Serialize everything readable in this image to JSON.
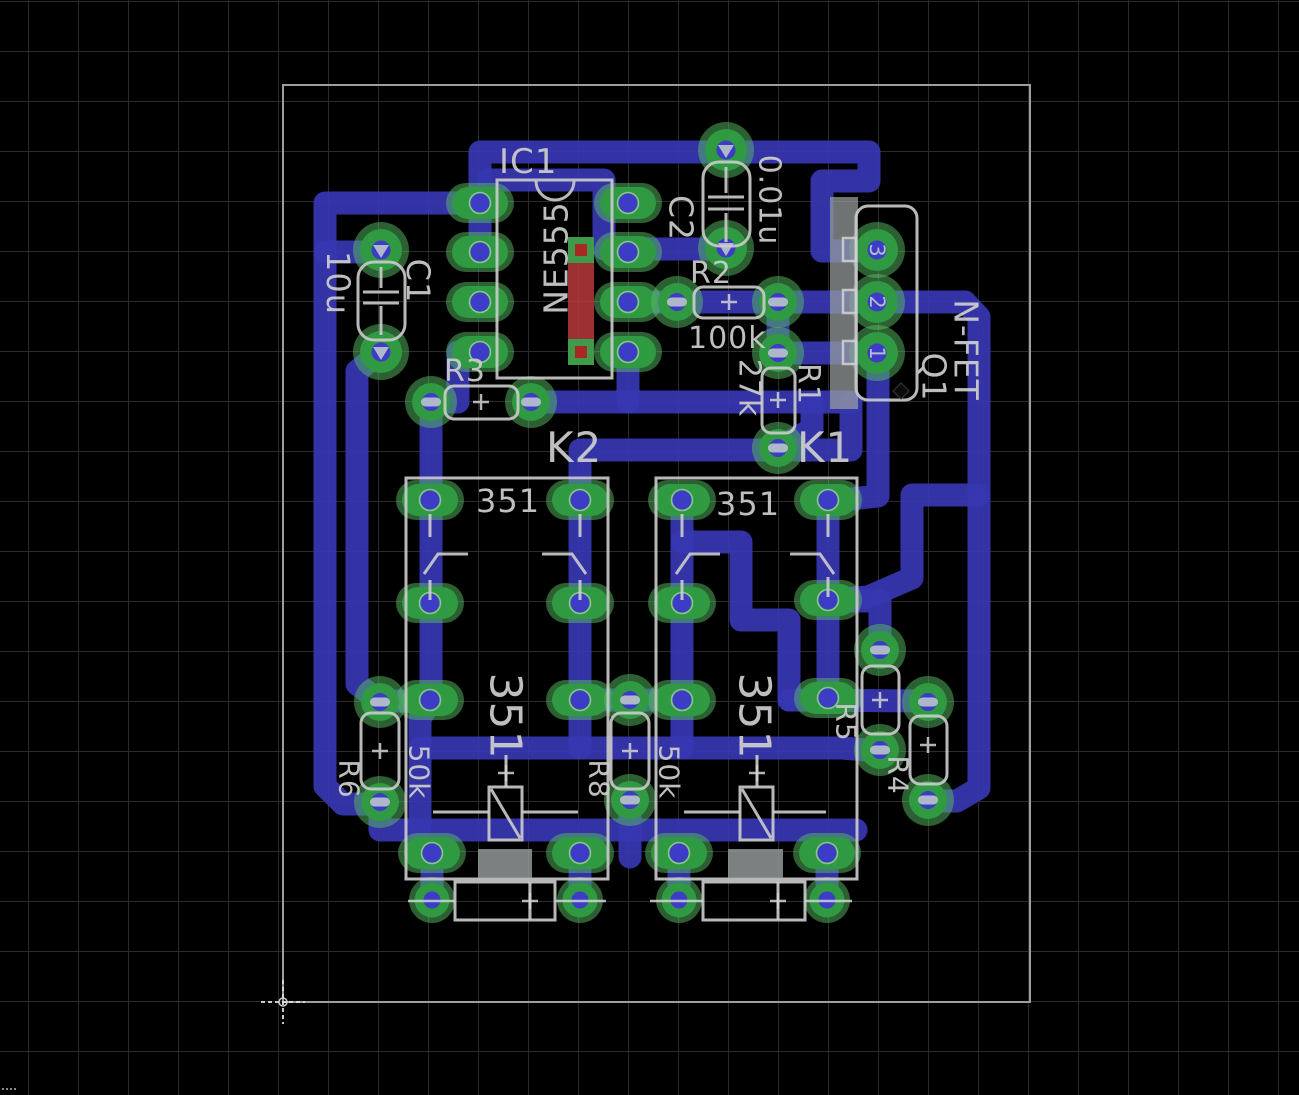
{
  "app": {
    "name": "pcb-layout-editor",
    "view": "board-bottom-copper"
  },
  "palette": {
    "background": "#000000",
    "grid": "#2b2b2b",
    "bottom_copper": "#3737b2",
    "top_copper": "#bf3a3a",
    "pad_green": "#2f9a42",
    "pad_halo": "#57bd62",
    "pad_hole": "#3c3cc6",
    "silkscreen": "#cccccc",
    "board_outline": "#9e9e9e",
    "tab_gray": "#9aa0a0"
  },
  "components": {
    "ic1": {
      "ref": "IC1",
      "value": "NE555"
    },
    "c1": {
      "ref": "C1",
      "value": "10u"
    },
    "c2": {
      "ref": "C2",
      "value": "0.01u"
    },
    "r1": {
      "ref": "R1",
      "value": "27k"
    },
    "r2": {
      "ref": "R2",
      "value": "100k"
    },
    "r3": {
      "ref": "R3"
    },
    "r4": {
      "ref": "R4"
    },
    "r5": {
      "ref": "R5"
    },
    "r6": {
      "ref": "R6",
      "value": "50k"
    },
    "r8": {
      "ref": "R8",
      "value": "50k"
    },
    "k2": {
      "ref": "K2",
      "type": "351",
      "type_side": "351"
    },
    "k1": {
      "ref": "K1",
      "type": "351",
      "type_side": "351"
    },
    "q1": {
      "ref": "Q1",
      "value": "N-FET",
      "pins": [
        "3",
        "2",
        "1"
      ]
    }
  }
}
